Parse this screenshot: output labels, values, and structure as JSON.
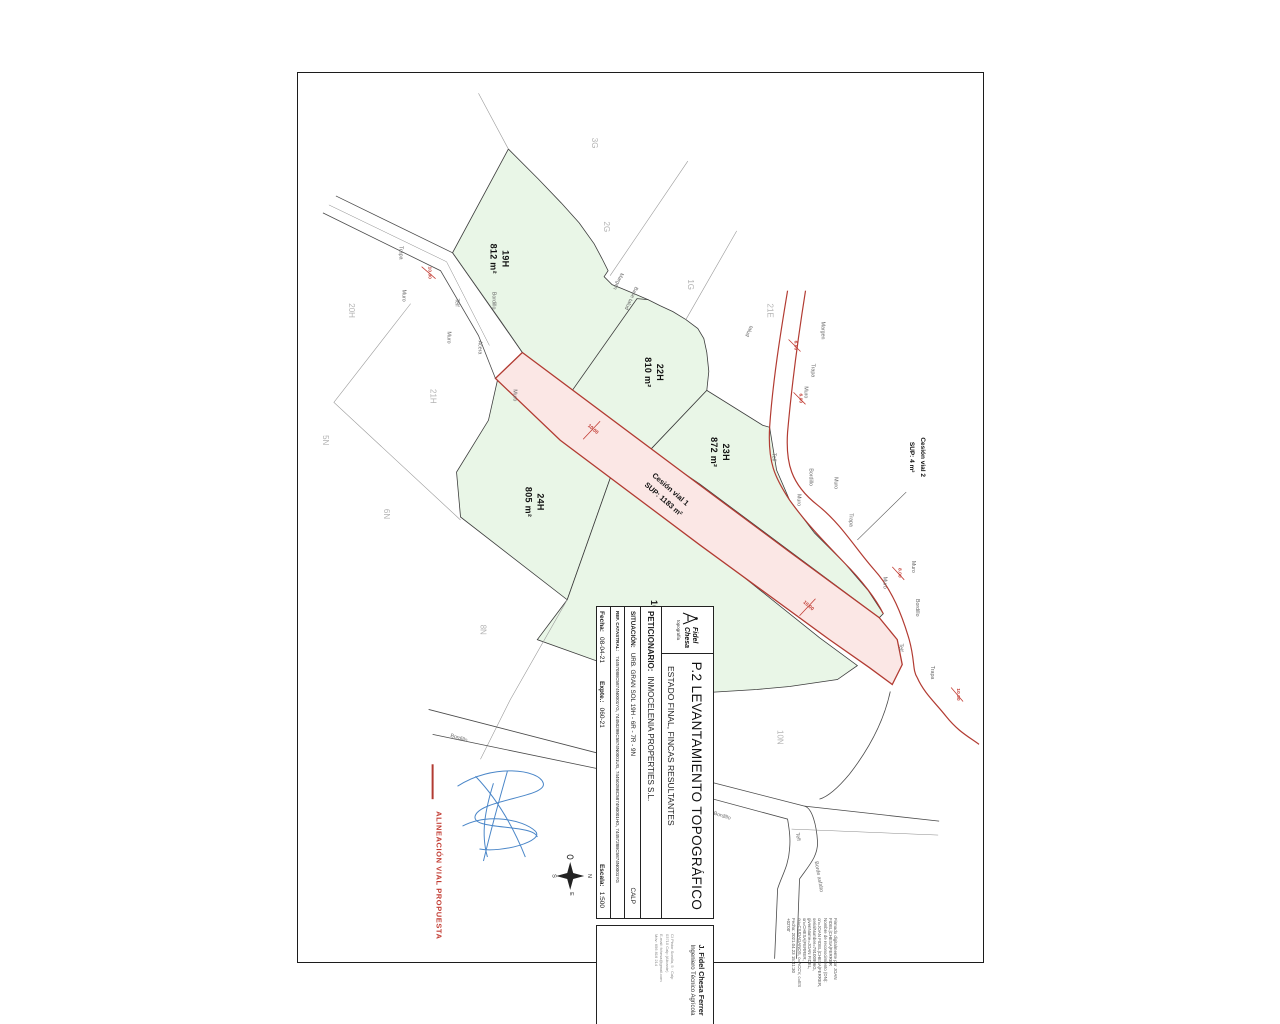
{
  "colors": {
    "parcel_green": "#e9f6e7",
    "cession_pink": "#fbe7e5",
    "alignment_red": "#b23b32",
    "signature_blue": "#4a86c8",
    "region_label_gray": "#b3b3b3"
  },
  "title_block": {
    "logo_name_1": "Fidel",
    "logo_name_2": "Chesa",
    "logo_sub": "topografía",
    "title": "P.2 LEVANTAMIENTO TOPOGRÁFICO",
    "subtitle": "ESTADO FINAL, FINCAS RESULTANTES",
    "petitioner_label": "PETICIONARIO:",
    "petitioner": "INMOCELENIA PROPERTIES S.L.",
    "situation_label": "SITUACIÓN:",
    "situation": "URB. GRAN SOL 19H - 6R - 7R - 9N",
    "municipality": "CALP",
    "cadastral_label": "REF. CATASTRAL:",
    "cadastral": "7445708BC5874N0001YG, 7445029BC5874N0001UG, 7445028BC5874N0001HG, 7445728BC5874N0001YG",
    "date_label": "Fecha:",
    "date": "08-04-21",
    "file_label": "Expte.:",
    "file_number": "060-21",
    "scale_label": "Escala:",
    "scale": "1:500"
  },
  "engineer_block": {
    "name": "J. Fidel Chesa Ferrer",
    "role": "Ingeniero Técnico Agrícola",
    "contact_lines": [
      "C/ Pintor Sorolla, 5 · Calp",
      "03710 Calp (Alicante)",
      "E-mail: fchesa@gmail.com",
      "Móv: 656 816 214"
    ]
  },
  "legend": {
    "alignment_label": "ALINEACIÓN VIAL PROPUESTA"
  },
  "compass": {
    "north": "N",
    "south": "S",
    "east": "E",
    "west": "O"
  },
  "digital_signature": {
    "lines": [
      "Firmado digitalmente por JOAN",
      "FIDEL|CHESA|FERRER",
      "Nombre de reconocimiento (DN):",
      "cn=JOAN FIDEL|CHESA|FERRER,",
      "serialNumber=79100996G,",
      "givenName=JOAN FIDEL,",
      "sn=CHESA|FERRER,",
      "ou=CIUDADANOS, o=ACCV, c=ES",
      "Fecha: 2021.04.23 15:41:30",
      "+02'00'"
    ]
  },
  "map": {
    "parcels": [
      {
        "id": "19H",
        "area": "812 m²"
      },
      {
        "id": "22H",
        "area": "810 m²"
      },
      {
        "id": "23H",
        "area": "872 m²"
      },
      {
        "id": "24H",
        "area": "805 m²"
      },
      {
        "id": "25H",
        "area": "1023 m²"
      }
    ],
    "cessions": [
      {
        "name": "Cesión vial 1",
        "sup": "SUP: 1183 m²"
      },
      {
        "name": "Cesión vial 2",
        "sup": "SUP: 4 m²"
      }
    ],
    "regions": [
      "3G",
      "2G",
      "1G",
      "21E",
      "20H",
      "21H",
      "5N",
      "6N",
      "8N",
      "10N"
    ],
    "road_labels": [
      "Muro",
      "Telf",
      "Bordillo",
      "Muro",
      "Acera",
      "Muro",
      "Trapa",
      "Margen",
      "Base talud",
      "talud",
      "Margen",
      "Muro",
      "Trapa",
      "Telf",
      "Bordillo",
      "Muro",
      "Muro",
      "Trapa",
      "Muro",
      "Muro",
      "Bordillo",
      "Telf",
      "Trapa",
      "Bordillo",
      "Bordillo",
      "Telf",
      "Borde asfalto"
    ],
    "dimensions": [
      "10.00",
      "6.00",
      "6.00",
      "10.00",
      "10.00",
      "8.00",
      "10.00"
    ]
  }
}
